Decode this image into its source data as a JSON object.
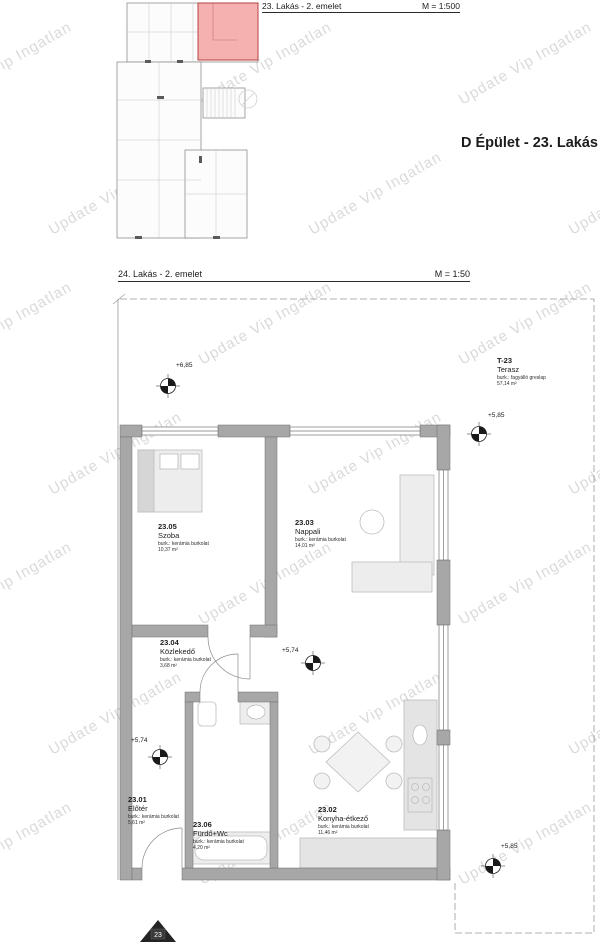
{
  "watermark": {
    "text": "Update Vip Ingatlan"
  },
  "header": {
    "keyplan_title": "23. Lakás - 2. emelet",
    "keyplan_scale": "M = 1:500",
    "building_title": "D Épület - 23. Lakás"
  },
  "section": {
    "title": "24. Lakás - 2. emelet",
    "scale": "M = 1:50"
  },
  "plan": {
    "rooms": [
      {
        "number": "23.01",
        "name": "Előtér",
        "finish": "burk.: kerámia burkolat",
        "area": "5,61 m²"
      },
      {
        "number": "23.02",
        "name": "Konyha-étkező",
        "finish": "burk.: kerámia burkolat",
        "area": "11,46 m²"
      },
      {
        "number": "23.03",
        "name": "Nappali",
        "finish": "burk.: kerámia burkolat",
        "area": "14,01 m²"
      },
      {
        "number": "23.04",
        "name": "Közlekedő",
        "finish": "burk.: kerámia burkolat",
        "area": "3,68 m²"
      },
      {
        "number": "23.05",
        "name": "Szoba",
        "finish": "burk.: kerámia burkolat",
        "area": "10,37 m²"
      },
      {
        "number": "23.06",
        "name": "Fürdő+Wc",
        "finish": "burk.: kerámia burkolat",
        "area": "4,20 m²"
      },
      {
        "number": "T-23",
        "name": "Terasz",
        "finish": "burk.: fagyálló greslap",
        "area": "57,14 m²"
      }
    ],
    "elevations": [
      {
        "label": "+6,85"
      },
      {
        "label": "+5,85"
      },
      {
        "label": "+5,74"
      },
      {
        "label": "+5,74"
      },
      {
        "label": "+5,85"
      }
    ],
    "entrance_badge": "23"
  },
  "colors": {
    "unit_highlight": "#ef8a8a",
    "walls": "#a7a7a7",
    "watermark": "#c4c4c4"
  }
}
